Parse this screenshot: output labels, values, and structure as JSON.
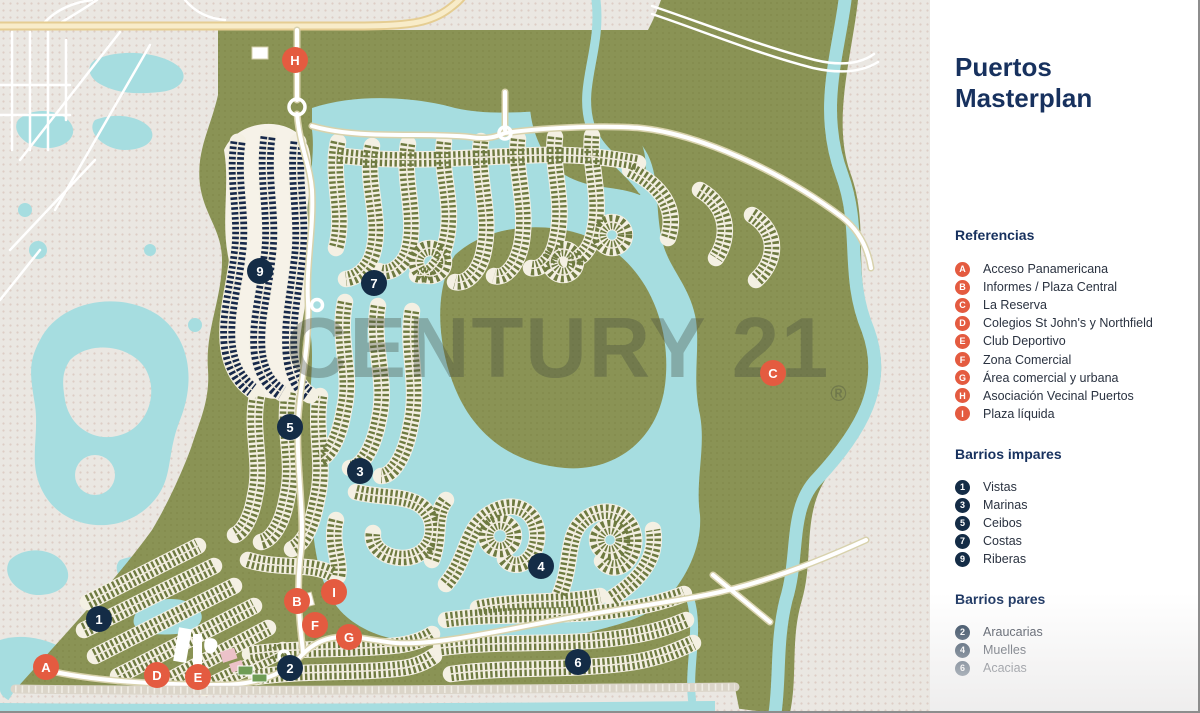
{
  "title": "Puertos Masterplan",
  "watermark": {
    "text": "CENTURY 21",
    "reg": "®"
  },
  "colors": {
    "accent_orange": "#E45B40",
    "navy": "#142C46",
    "title_navy": "#17315E",
    "land_olive": "#8A9355",
    "lot_olive": "#6E7A40",
    "dark_barrio_navy": "#17294A",
    "water_blue": "#A6DDE0",
    "background_gray": "#EAE7E2",
    "highway_yellow": "#F8ECC9",
    "road_white": "#FFFFFF"
  },
  "legend": {
    "referencias_heading": "Referencias",
    "referencias": [
      {
        "key": "A",
        "label": "Acceso Panamericana"
      },
      {
        "key": "B",
        "label": "Informes / Plaza Central"
      },
      {
        "key": "C",
        "label": "La Reserva"
      },
      {
        "key": "D",
        "label": "Colegios St John's y Northfield"
      },
      {
        "key": "E",
        "label": "Club Deportivo"
      },
      {
        "key": "F",
        "label": "Zona Comercial"
      },
      {
        "key": "G",
        "label": "Área comercial y urbana"
      },
      {
        "key": "H",
        "label": "Asociación Vecinal Puertos"
      },
      {
        "key": "I",
        "label": "Plaza líquida"
      }
    ],
    "impares_heading": "Barrios impares",
    "impares": [
      {
        "key": "1",
        "label": "Vistas"
      },
      {
        "key": "3",
        "label": "Marinas"
      },
      {
        "key": "5",
        "label": "Ceibos"
      },
      {
        "key": "7",
        "label": "Costas"
      },
      {
        "key": "9",
        "label": "Riberas"
      }
    ],
    "pares_heading": "Barrios pares",
    "pares": [
      {
        "key": "2",
        "label": "Araucarias"
      },
      {
        "key": "4",
        "label": "Muelles"
      },
      {
        "key": "6",
        "label": "Acacias"
      }
    ]
  },
  "map": {
    "markers": [
      {
        "key": "H",
        "type": "orange",
        "x": 295,
        "y": 60
      },
      {
        "key": "9",
        "type": "navy",
        "x": 260,
        "y": 271
      },
      {
        "key": "7",
        "type": "navy",
        "x": 374,
        "y": 283
      },
      {
        "key": "C",
        "type": "orange",
        "x": 773,
        "y": 373
      },
      {
        "key": "5",
        "type": "navy",
        "x": 290,
        "y": 427
      },
      {
        "key": "3",
        "type": "navy",
        "x": 360,
        "y": 471
      },
      {
        "key": "4",
        "type": "navy",
        "x": 541,
        "y": 566
      },
      {
        "key": "1",
        "type": "navy",
        "x": 99,
        "y": 619
      },
      {
        "key": "I",
        "type": "orange",
        "x": 334,
        "y": 592
      },
      {
        "key": "B",
        "type": "orange",
        "x": 297,
        "y": 601
      },
      {
        "key": "F",
        "type": "orange",
        "x": 315,
        "y": 625
      },
      {
        "key": "G",
        "type": "orange",
        "x": 349,
        "y": 637
      },
      {
        "key": "2",
        "type": "navy",
        "x": 290,
        "y": 668
      },
      {
        "key": "6",
        "type": "navy",
        "x": 578,
        "y": 662
      },
      {
        "key": "A",
        "type": "orange",
        "x": 46,
        "y": 667
      },
      {
        "key": "D",
        "type": "orange",
        "x": 157,
        "y": 675
      },
      {
        "key": "E",
        "type": "orange",
        "x": 198,
        "y": 677
      }
    ]
  }
}
